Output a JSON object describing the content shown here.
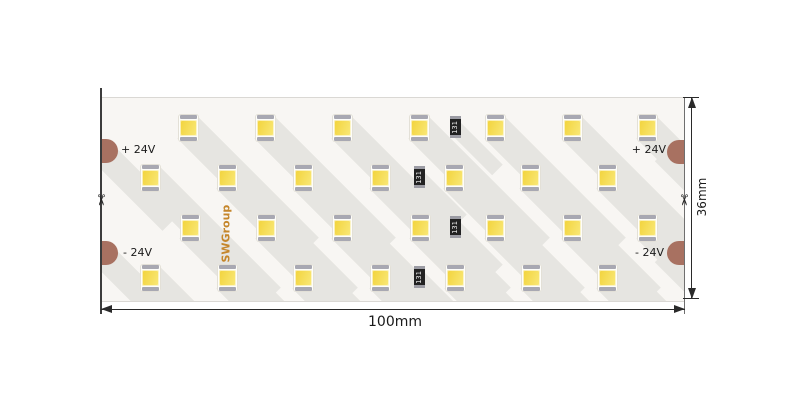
{
  "drawing": {
    "brand": "SWGroup",
    "cut_mark": "✂",
    "resistor_code": "131",
    "dimensions": {
      "width_label": "100mm",
      "height_label": "36mm"
    },
    "terminals": {
      "left_positive": "+ 24V",
      "left_negative": "- 24V",
      "right_positive": "+ 24V",
      "right_negative": "- 24V"
    }
  },
  "colors": {
    "strip_background": "#F8F6F3",
    "shadow": "#E6E5E1",
    "led_phosphor": "#F5DB4E",
    "led_terminal": "#A8A8B2",
    "solder_pad": "#A87161",
    "resistor_body": "#222222",
    "brand_text": "#C5862B",
    "line": "#2A2A2A"
  },
  "layout": {
    "strip": {
      "x": 101,
      "y": 97,
      "w": 583,
      "h": 203
    },
    "led_rows": [
      {
        "y": 127,
        "x": [
          188,
          265,
          342,
          419,
          495,
          572,
          647
        ]
      },
      {
        "y": 177,
        "x": [
          150,
          227,
          303,
          380,
          454,
          530,
          607
        ]
      },
      {
        "y": 227,
        "x": [
          190,
          266,
          342,
          420,
          495,
          572,
          647
        ]
      },
      {
        "y": 277,
        "x": [
          150,
          227,
          303,
          380,
          455,
          531,
          607
        ]
      }
    ],
    "resistors": [
      {
        "x": 455,
        "y": 126
      },
      {
        "x": 419,
        "y": 176
      },
      {
        "x": 455,
        "y": 226
      },
      {
        "x": 419,
        "y": 276
      }
    ],
    "pads": [
      {
        "x": 101,
        "y": 150,
        "side": "left"
      },
      {
        "x": 101,
        "y": 252,
        "side": "left"
      },
      {
        "x": 684,
        "y": 151,
        "side": "right"
      },
      {
        "x": 684,
        "y": 252,
        "side": "right"
      }
    ]
  }
}
